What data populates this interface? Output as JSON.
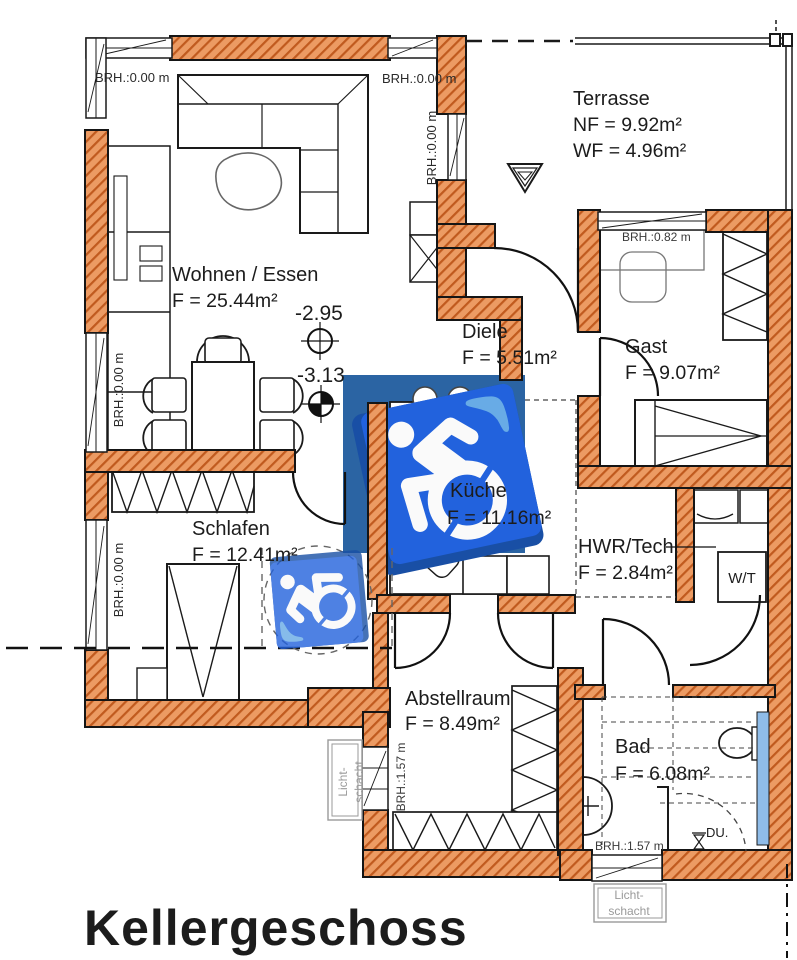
{
  "title": "Kellergeschoss",
  "rooms": {
    "wohnen": {
      "name": "Wohnen / Essen",
      "area": "F = 25.44m²"
    },
    "terrasse": {
      "name": "Terrasse",
      "nf": "NF = 9.92m²",
      "wf": "WF = 4.96m²"
    },
    "diele": {
      "name": "Diele",
      "area": "F = 5.51m²"
    },
    "gast": {
      "name": "Gast",
      "area": "F = 9.07m²"
    },
    "kueche": {
      "name": "Küche",
      "area": "F = 11.16m²"
    },
    "hwr": {
      "name": "HWR/Tech.",
      "area": "F = 2.84m²"
    },
    "schlafen": {
      "name": "Schlafen",
      "area": "F = 12.41m²"
    },
    "abstellraum": {
      "name": "Abstellraum",
      "area": "F = 8.49m²"
    },
    "bad": {
      "name": "Bad",
      "area": "F = 6.08m²"
    }
  },
  "sills": {
    "top_left": "BRH.:0.00 m",
    "top_right": "BRH.:0.00 m",
    "wohnen_right": "BRH.:0.00 m",
    "left_upper": "BRH.:0.00 m",
    "left_lower": "BRH.:0.00 m",
    "gast": "BRH.:0.82 m",
    "abstellraum": "BRH.:1.57 m",
    "bad": "BRH.:1.57 m"
  },
  "levels": {
    "wohnen": "-2.95",
    "diele": "-3.13"
  },
  "fixtures": {
    "washer_dryer": "W/T",
    "shower": "DU."
  },
  "light_shaft": {
    "line1": "Licht-",
    "line2": "schacht"
  },
  "icons": {
    "accessibility": "♿"
  },
  "colors": {
    "wall_fill": "#EC9B63",
    "wall_hatch": "#C05A1E",
    "accessibility_blue": "#2B64A3",
    "glass_blue": "#8FBCE8"
  }
}
